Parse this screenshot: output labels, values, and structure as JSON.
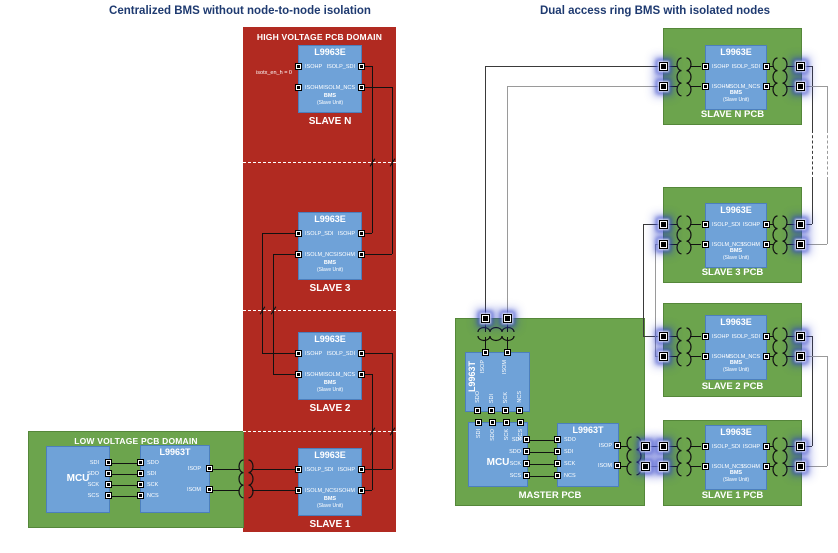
{
  "palette": {
    "domain_red": "#b12a21",
    "pcb_green": "#6ca44d",
    "chip_blue": "#6fa2d8",
    "chip_border": "#4c7fbd",
    "title_text": "#1e3a70",
    "wire_black": "#111111",
    "wire_dark": "#3a3a3a",
    "wire_gray": "#9a9a9a",
    "terminal_glow_blue": "#2f40c9"
  },
  "left": {
    "title": "Centralized BMS without node-to-node isolation",
    "hv_label": "HIGH VOLTAGE PCB DOMAIN",
    "lv_label": "LOW VOLTAGE PCB DOMAIN",
    "annotation": "isotx_en_h = 0",
    "mcu_label": "MCU",
    "mcu_pins": [
      "SDI",
      "SDO",
      "SCK",
      "SCS"
    ],
    "t_label": "L9963T",
    "t_pins_left": [
      "SDO",
      "SDI",
      "SCK",
      "NCS"
    ],
    "t_pins_right": [
      "ISOP",
      "ISOM"
    ],
    "bms_line1": "BMS",
    "bms_line2": "(Slave Unit)",
    "slaves": [
      {
        "chip": "L9963E",
        "name": "SLAVE N",
        "left": [
          "ISOHP",
          "ISOHM"
        ],
        "right": [
          "ISOLP_SDI",
          "ISOLM_NCS"
        ]
      },
      {
        "chip": "L9963E",
        "name": "SLAVE 3",
        "left": [
          "ISOLP_SDI",
          "ISOLM_NCS"
        ],
        "right": [
          "ISOHP",
          "ISOHM"
        ]
      },
      {
        "chip": "L9963E",
        "name": "SLAVE 2",
        "left": [
          "ISOHP",
          "ISOHM"
        ],
        "right": [
          "ISOLP_SDI",
          "ISOLM_NCS"
        ]
      },
      {
        "chip": "L9963E",
        "name": "SLAVE 1",
        "left": [
          "ISOLP_SDI",
          "ISOLM_NCS"
        ],
        "right": [
          "ISOHP",
          "ISOHM"
        ]
      }
    ]
  },
  "right": {
    "title": "Dual access ring BMS with isolated nodes",
    "master": {
      "pcb_label": "MASTER PCB",
      "mcu_label": "MCU",
      "mcu_pins_top": [
        "SDI",
        "SDO",
        "SCK",
        "SCS"
      ],
      "mcu_pins_right": [
        "SDI",
        "SDO",
        "SCK",
        "SCS"
      ],
      "tv_label": "L9963T",
      "tv_pins_top": [
        "ISOP",
        "ISOM"
      ],
      "tv_pins_bottom": [
        "SDO",
        "SDI",
        "SCK",
        "NCS"
      ],
      "tr_label": "L9963T",
      "tr_pins_left": [
        "SDO",
        "SDI",
        "SCK",
        "NCS"
      ],
      "tr_pins_right": [
        "ISOP",
        "ISOM"
      ]
    },
    "bms_line1": "BMS",
    "bms_line2": "(Slave Unit)",
    "slaves": [
      {
        "chip": "L9963E",
        "pcb": "SLAVE N PCB",
        "left": [
          "ISOHP",
          "ISOHM"
        ],
        "right": [
          "ISOLP_SDI",
          "ISOLM_NCS"
        ]
      },
      {
        "chip": "L9963E",
        "pcb": "SLAVE 3 PCB",
        "left": [
          "ISOLP_SDI",
          "ISOLM_NCS"
        ],
        "right": [
          "ISOHP",
          "ISOHM"
        ]
      },
      {
        "chip": "L9963E",
        "pcb": "SLAVE 2 PCB",
        "left": [
          "ISOHP",
          "ISOHM"
        ],
        "right": [
          "ISOLP_SDI",
          "ISOLM_NCS"
        ]
      },
      {
        "chip": "L9963E",
        "pcb": "SLAVE 1 PCB",
        "left": [
          "ISOLP_SDI",
          "ISOLM_NCS"
        ],
        "right": [
          "ISOHP",
          "ISOHM"
        ]
      }
    ]
  }
}
